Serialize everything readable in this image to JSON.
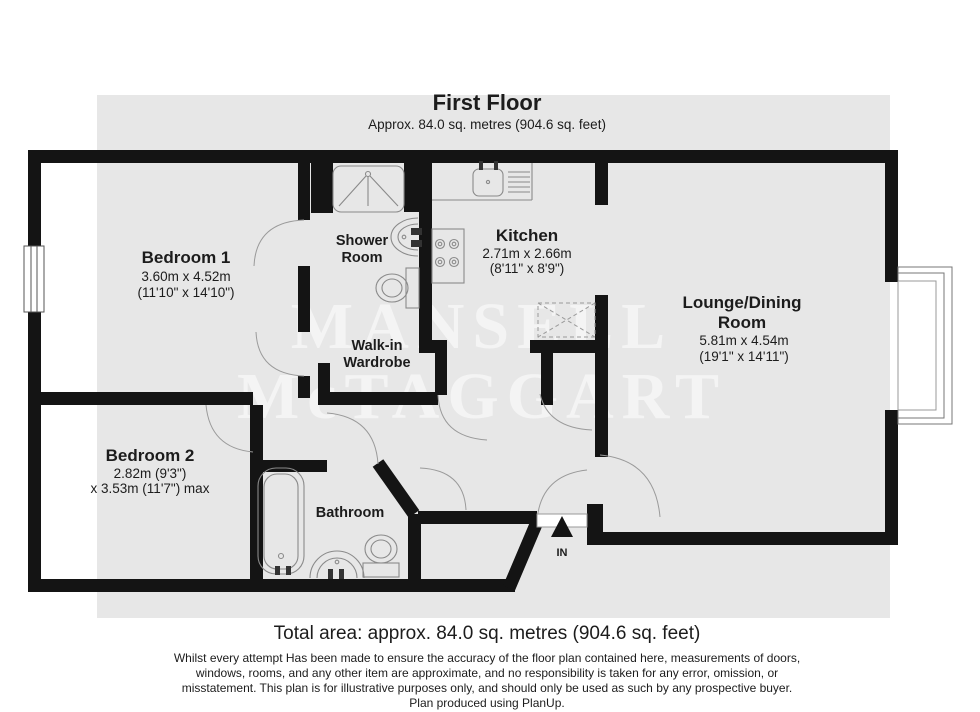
{
  "header": {
    "title": "First Floor",
    "subtitle": "Approx. 84.0 sq. metres (904.6 sq. feet)"
  },
  "rooms": {
    "bedroom1": {
      "name": "Bedroom 1",
      "dims_metric": "3.60m x 4.52m",
      "dims_imperial": "(11'10\" x 14'10\")"
    },
    "shower": {
      "name_line1": "Shower",
      "name_line2": "Room"
    },
    "kitchen": {
      "name": "Kitchen",
      "dims_metric": "2.71m x 2.66m",
      "dims_imperial": "(8'11\" x 8'9\")"
    },
    "lounge": {
      "name_line1": "Lounge/Dining",
      "name_line2": "Room",
      "dims_metric": "5.81m x 4.54m",
      "dims_imperial": "(19'1\" x 14'11\")"
    },
    "wardrobe": {
      "name_line1": "Walk-in",
      "name_line2": "Wardrobe"
    },
    "bedroom2": {
      "name": "Bedroom 2",
      "dims_line1": "2.82m (9'3\")",
      "dims_line2": "x 3.53m (11'7\") max"
    },
    "bathroom": {
      "name": "Bathroom"
    }
  },
  "entrance": {
    "label": "IN"
  },
  "watermark": {
    "line1": "MANSELL",
    "line2": "McTAGGART"
  },
  "footer": {
    "total_area": "Total area: approx. 84.0 sq. metres (904.6 sq. feet)",
    "disclaimer_lines": [
      "Whilst every attempt Has been made to ensure the accuracy of the floor plan contained here, measurements of doors,",
      "windows, rooms, and any other item are approximate, and no responsibility is taken for any error, omission, or",
      "misstatement. This plan is for illustrative purposes only, and should only be used as such by any prospective buyer.",
      "Plan produced using PlanUp."
    ]
  },
  "colors": {
    "wall": "#141414",
    "floor_band": "#e7e7e7",
    "fixture_line": "#8a8a8a",
    "watermark": "#ffffff"
  }
}
